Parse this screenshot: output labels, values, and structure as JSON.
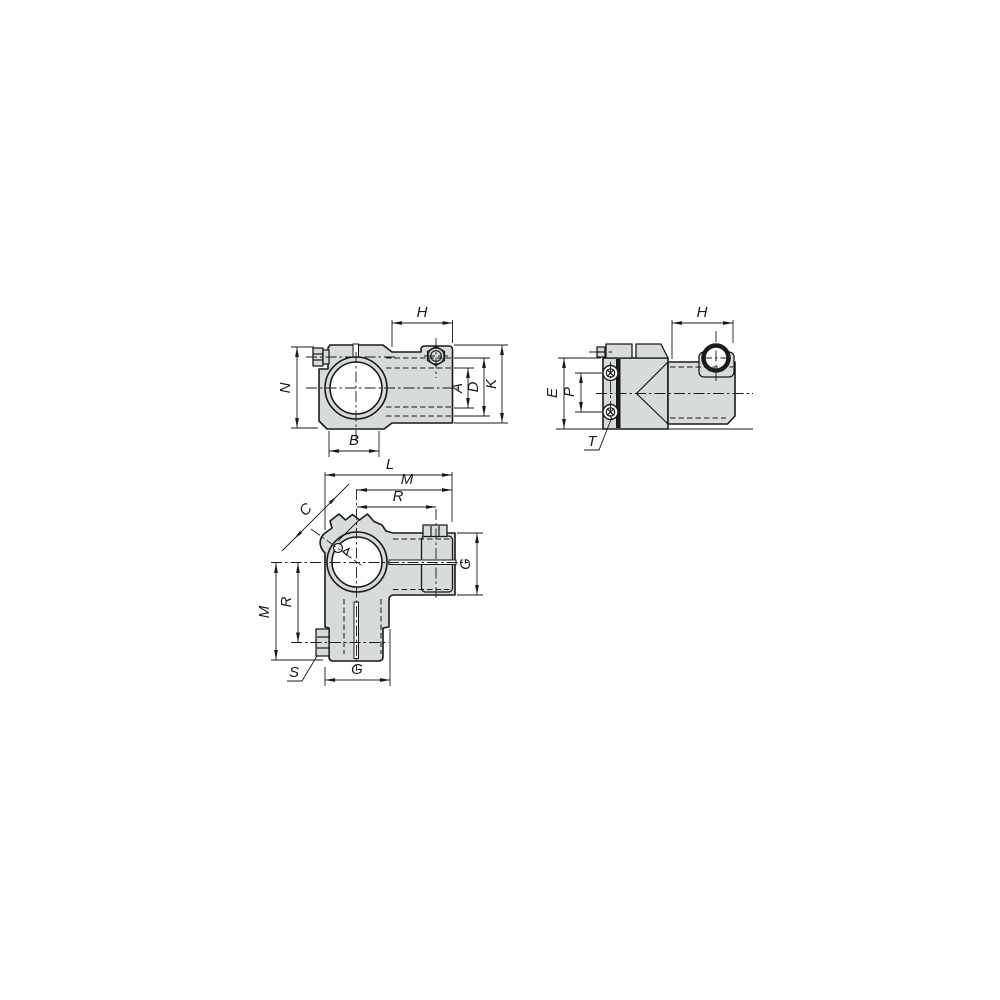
{
  "drawing": {
    "views": {
      "front": {
        "dims": {
          "H": "H",
          "N": "N",
          "A": "A",
          "D": "D",
          "K": "K",
          "B": "B"
        }
      },
      "side": {
        "dims": {
          "H": "H",
          "E": "E",
          "P": "P"
        },
        "callouts": {
          "T": "T"
        }
      },
      "plan": {
        "dims": {
          "L": "L",
          "M_top": "M",
          "R_top": "R",
          "C": "C",
          "G_right": "G",
          "M_left": "M",
          "R_left": "R",
          "G_bottom": "G"
        },
        "callouts": {
          "S": "S"
        }
      }
    }
  },
  "colors": {
    "background": "#ffffff",
    "part_fill": "#d7dbdc",
    "line": "#1a1a1a"
  }
}
